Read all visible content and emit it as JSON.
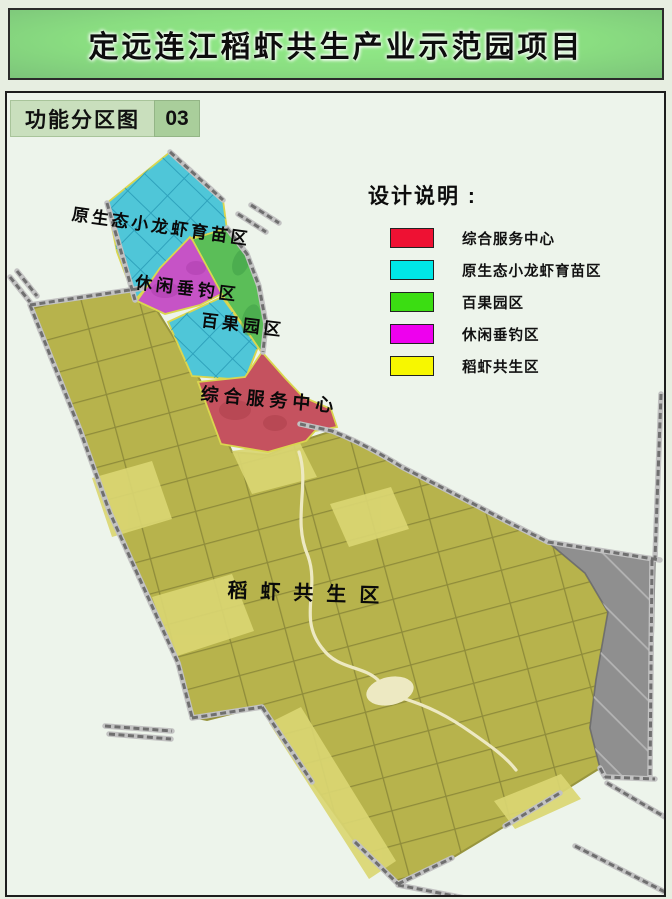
{
  "page_title": "定远连江稻虾共生产业示范园项目",
  "tab": {
    "label": "功能分区图",
    "number": "03"
  },
  "legend": {
    "title": "设计说明 :",
    "items": [
      {
        "label": "综合服务中心",
        "color": "#ee1133"
      },
      {
        "label": "原生态小龙虾育苗区",
        "color": "#00e7e7"
      },
      {
        "label": "百果园区",
        "color": "#3bdd12"
      },
      {
        "label": "休闲垂钓区",
        "color": "#ee00ee"
      },
      {
        "label": "稻虾共生区",
        "color": "#f7f700"
      }
    ]
  },
  "map": {
    "labels": [
      {
        "text": "原生态小龙虾育苗区"
      },
      {
        "text": "休闲垂钓区"
      },
      {
        "text": "百果园区"
      },
      {
        "text": "综合服务中心"
      },
      {
        "text": "稻虾共生区"
      }
    ],
    "zones": {
      "rice_shrimp": {
        "name": "稻虾共生区",
        "fill": "#b7b34c"
      },
      "crayfish_nursery": {
        "name": "原生态小龙虾育苗区",
        "fill": "#4fc6d8"
      },
      "fishing": {
        "name": "休闲垂钓区",
        "fill": "#c653c6"
      },
      "orchard": {
        "name": "百果园区",
        "fill": "#5bbe58"
      },
      "service_center": {
        "name": "综合服务中心",
        "fill": "#c5525f"
      },
      "village": {
        "name": "现状建设用地",
        "fill": "#8f8f8f"
      }
    }
  }
}
